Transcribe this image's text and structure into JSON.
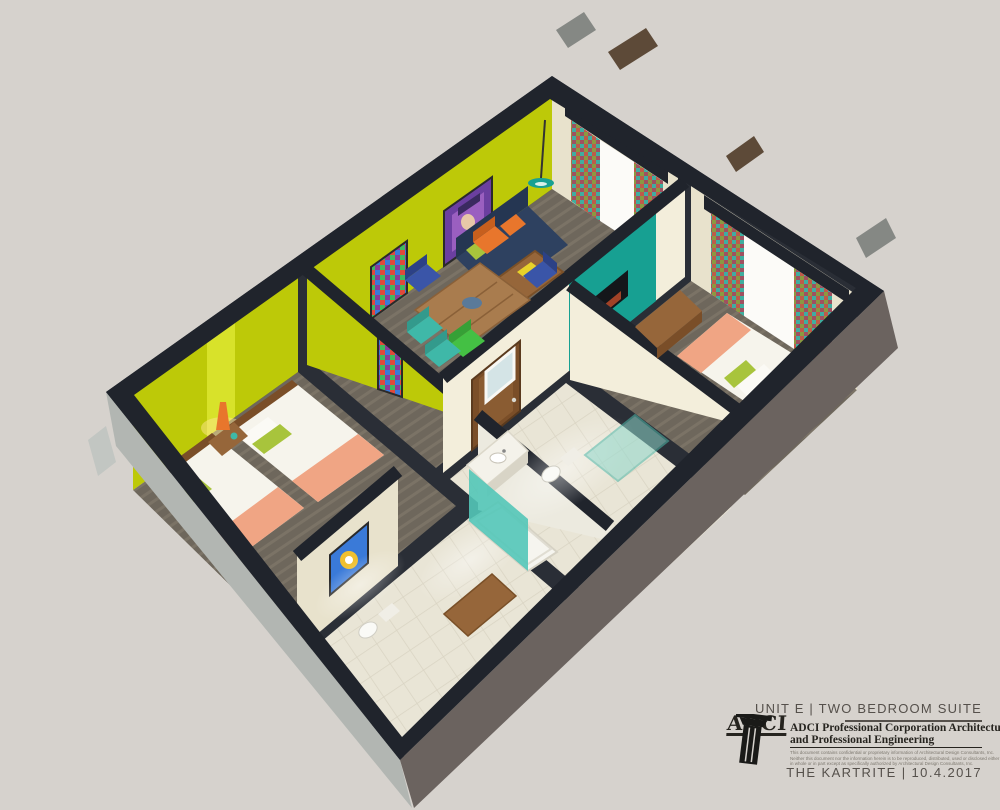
{
  "palette": {
    "bg": "#d6d2cd",
    "wallDark": "#2a2e36",
    "wallCap": "#20242c",
    "yellow": "#bdc908",
    "yellowLit": "#d8e22a",
    "beige": "#e8e2cc",
    "beigeLit": "#f3eedb",
    "teal": "#17a092",
    "tealGlass": "#8fd8cc",
    "tealCurtain": "#53c6b8",
    "wood": "#96663a",
    "woodDark": "#7a4e28",
    "navy": "#2e4160",
    "navyDark": "#253652",
    "white": "#f6f4ec",
    "coral": "#f0a584",
    "lime": "#a8c43c",
    "orange": "#e8762c",
    "carpet": "#6e675c",
    "carpetStripe": "#7b7366",
    "tile": "#e9e5d6",
    "tileLine": "#d9d4c3",
    "extGrey": "#b2b6b2",
    "extBrown": "#6b635f",
    "post": "#5d4a38",
    "postGrey": "#858884",
    "ink": "#26241f",
    "inkSoft": "#55504b",
    "inkFaint": "#7d786f",
    "chairBlue": "#3a55a8",
    "chairGreen": "#44c044",
    "chairTeal": "#3fb8a8",
    "artPurple": "#6b3fa0"
  },
  "title_block": {
    "unit_label": "UNIT E |  TWO BEDROOM SUITE",
    "logo_text": "ADCI",
    "firm_name_line1": "ADCI Professional Corporation Architecture",
    "firm_name_line2": "and Professional Engineering",
    "disclaimer_line1": "This document contains confidential or proprietary information of Architectural Design Consultants, Inc.",
    "disclaimer_line2": "Neither this document nor the information herein is to be reproduced, distributed, used or disclosed either",
    "disclaimer_line3": "in whole or in part except as specifically authorized by Architectural Design Consultants, Inc.",
    "project_date_label": "THE KARTRITE | 10.4.2017"
  },
  "scene": {
    "view": "isometric-cutaway-3d-floor-plan",
    "rooms": [
      "living-dining",
      "bedroom-1-two-queens",
      "bedroom-2-king",
      "bathroom-1",
      "bathroom-2",
      "entry-hall"
    ],
    "furnishings": [
      "navy-sofa",
      "coffee-table",
      "dining-table",
      "six-metal-chairs",
      "two-queen-beds",
      "king-bed",
      "nightstand-with-lamp",
      "media-dresser",
      "wall-tv",
      "vanity-sink",
      "walk-in-shower",
      "bathtub-with-curtain",
      "toilets",
      "patterned-window-curtains",
      "pop-art-wall-prints",
      "teal-pendant-lamp"
    ]
  }
}
